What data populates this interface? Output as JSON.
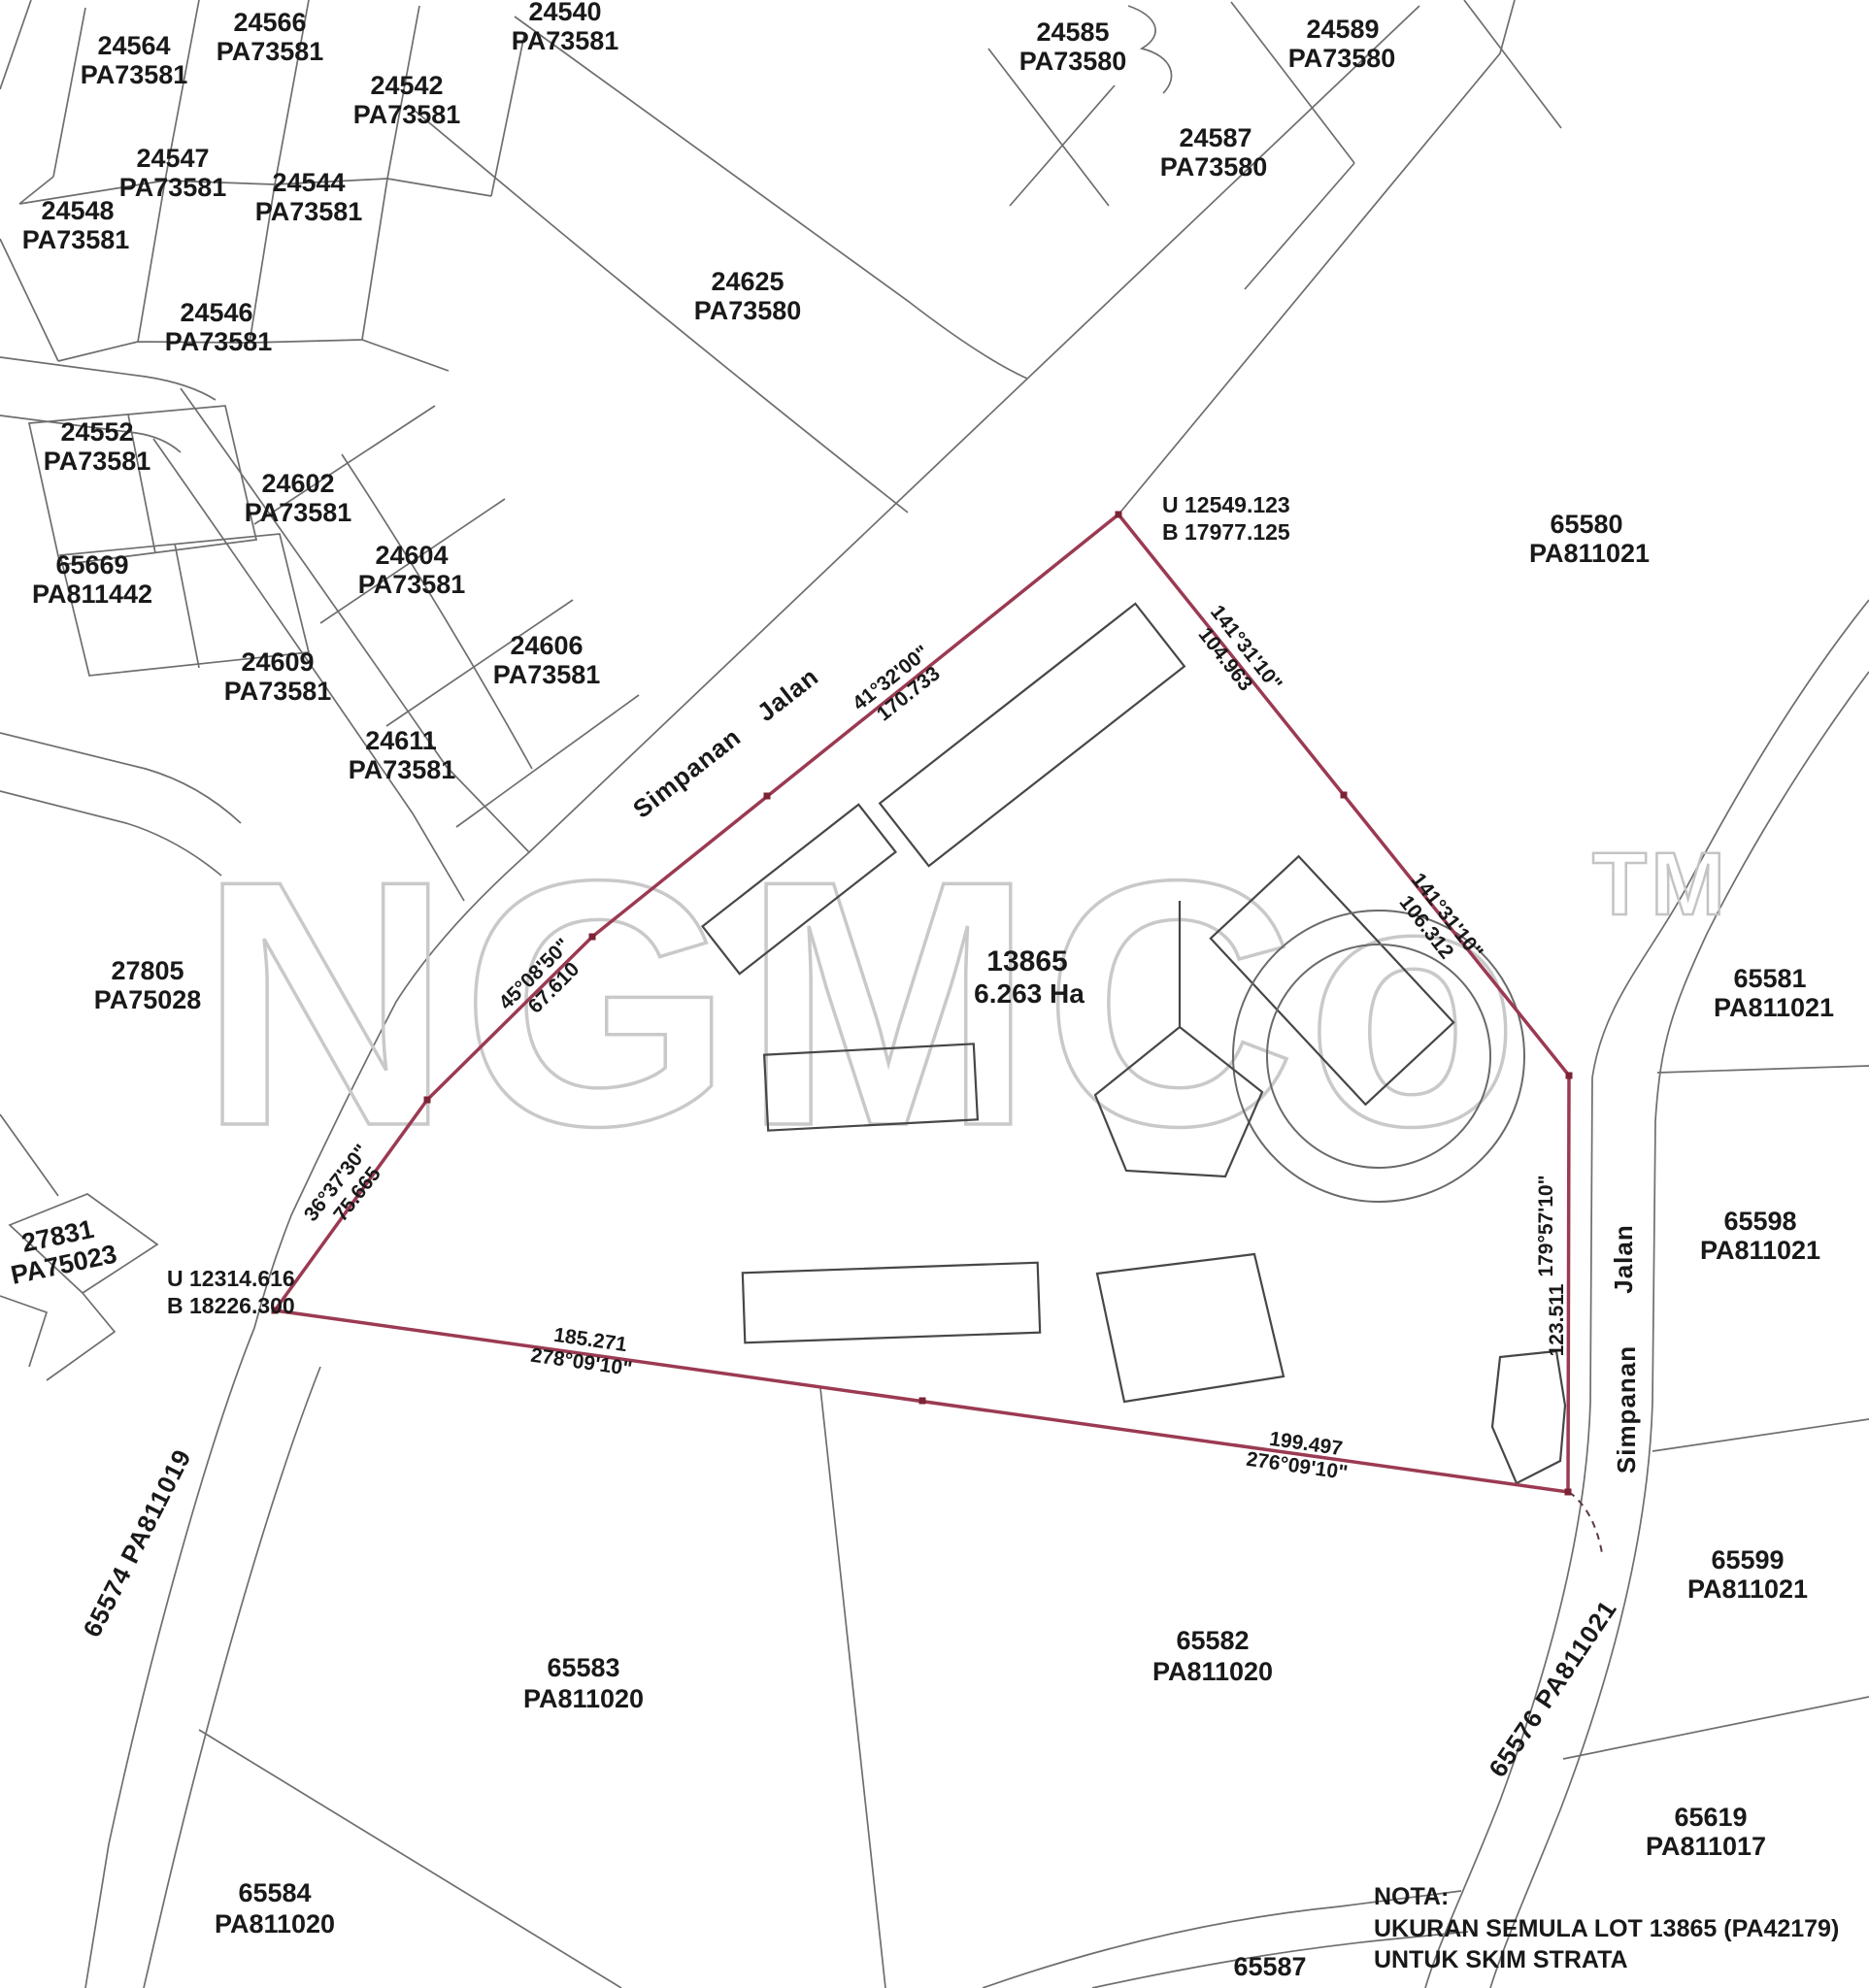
{
  "map": {
    "watermark": {
      "text": "NGMCo",
      "tm": "TM"
    },
    "subject": {
      "lot": "13865",
      "area": "6.263 Ha"
    },
    "note": {
      "title": "NOTA:",
      "line1": "UKURAN SEMULA LOT 13865 (PA42179)",
      "line2": "UNTUK SKIM STRATA"
    },
    "survey_points": [
      {
        "u": "U 12549.123",
        "b": "B 17977.125"
      },
      {
        "u": "U 12314.616",
        "b": "B 18226.300"
      }
    ],
    "roads": {
      "upper_word1": "Simpanan",
      "upper_word2": "Jalan",
      "right_word1": "Simpanan",
      "right_word2": "Jalan",
      "left_road": "65574 PA811019",
      "lower_right_road": "65576 PA811021"
    },
    "bearings": [
      {
        "line1": "41°32'00\"",
        "line2": "170.733"
      },
      {
        "line1": "141°31'10\"",
        "line2": "104.963"
      },
      {
        "line1": "141°31'10\"",
        "line2": "106.312"
      },
      {
        "line1": "45°08'50\"",
        "line2": "67.610"
      },
      {
        "line1": "36°37'30\"",
        "line2": "75.665"
      },
      {
        "line1": "185.271",
        "line2": "278°09'10\""
      },
      {
        "line1": "199.497",
        "line2": "276°09'10\""
      },
      {
        "line1": "179°57'10\"",
        "line2": "123.511"
      }
    ],
    "parcels": [
      {
        "lot": "24564",
        "pa": "PA73581"
      },
      {
        "lot": "24566",
        "pa": "PA73581"
      },
      {
        "lot": "24540",
        "pa": "PA73581"
      },
      {
        "lot": "24542",
        "pa": "PA73581"
      },
      {
        "lot": "24547",
        "pa": "PA73581"
      },
      {
        "lot": "24544",
        "pa": "PA73581"
      },
      {
        "lot": "24548",
        "pa": "PA73581"
      },
      {
        "lot": "24546",
        "pa": "PA73581"
      },
      {
        "lot": "24552",
        "pa": "PA73581"
      },
      {
        "lot": "65669",
        "pa": "PA811442"
      },
      {
        "lot": "24602",
        "pa": "PA73581"
      },
      {
        "lot": "24604",
        "pa": "PA73581"
      },
      {
        "lot": "24606",
        "pa": "PA73581"
      },
      {
        "lot": "24609",
        "pa": "PA73581"
      },
      {
        "lot": "24611",
        "pa": "PA73581"
      },
      {
        "lot": "24625",
        "pa": "PA73580"
      },
      {
        "lot": "24585",
        "pa": "PA73580"
      },
      {
        "lot": "24589",
        "pa": "PA73580"
      },
      {
        "lot": "24587",
        "pa": "PA73580"
      },
      {
        "lot": "27805",
        "pa": "PA75028"
      },
      {
        "lot": "27831",
        "pa": "PA75023"
      },
      {
        "lot": "65580",
        "pa": "PA811021"
      },
      {
        "lot": "65581",
        "pa": "PA811021"
      },
      {
        "lot": "65598",
        "pa": "PA811021"
      },
      {
        "lot": "65599",
        "pa": "PA811021"
      },
      {
        "lot": "65619",
        "pa": "PA811017"
      },
      {
        "lot": "65582",
        "pa": "PA811020"
      },
      {
        "lot": "65583",
        "pa": "PA811020"
      },
      {
        "lot": "65584",
        "pa": "PA811020"
      },
      {
        "lot": "65587",
        "pa": "PA811020"
      }
    ]
  }
}
